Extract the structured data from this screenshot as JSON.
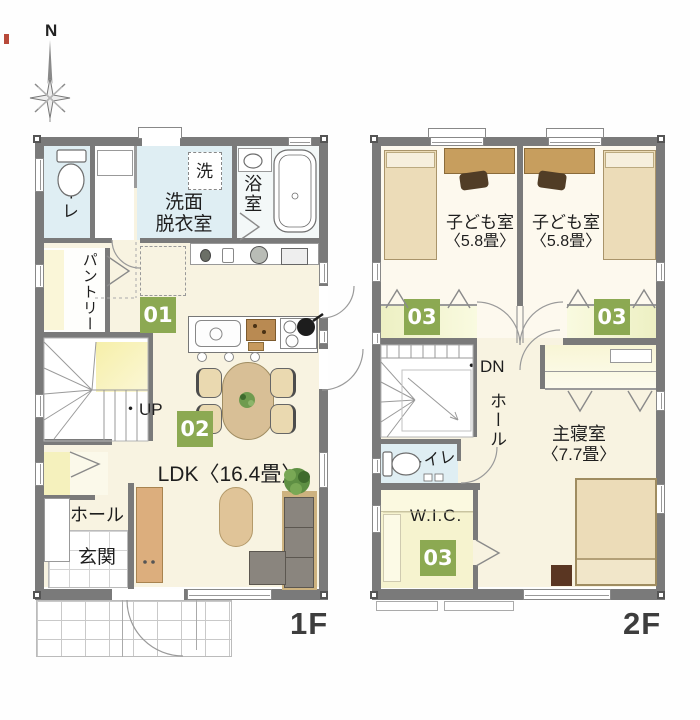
{
  "palette": {
    "badge_green": "#8ca952",
    "wall_gray": "#7a7a7a",
    "wet_blue": "#dfeef3",
    "floor_cream": "#f8f3e1",
    "closet_yellow": "#edf0c3",
    "wood_tan": "#c79e5e",
    "bed_beige": "#ecdcb8",
    "sofa_gray": "#8a857e"
  },
  "compass": {
    "north_label": "N"
  },
  "floor1": {
    "floor_label": "1F",
    "toilet": "トイレ",
    "washroom": [
      "洗面",
      "脱衣室"
    ],
    "washer": "洗",
    "bath": "浴室",
    "pantry": "パントリー",
    "up_label": "・UP",
    "badge_kitchen": "01",
    "badge_dining": "02",
    "ldk_label": "LDK〈16.4畳〉",
    "hall": "ホール",
    "entrance": "玄関"
  },
  "floor2": {
    "floor_label": "2F",
    "kids_room": "子ども室",
    "kids_size": "〈5.8畳〉",
    "badge_closet": "03",
    "dn_label": "・DN",
    "hall": "ホール",
    "toilet": "トイレ",
    "master": "主寝室",
    "master_size": "〈7.7畳〉",
    "wic": "W.I.C."
  }
}
